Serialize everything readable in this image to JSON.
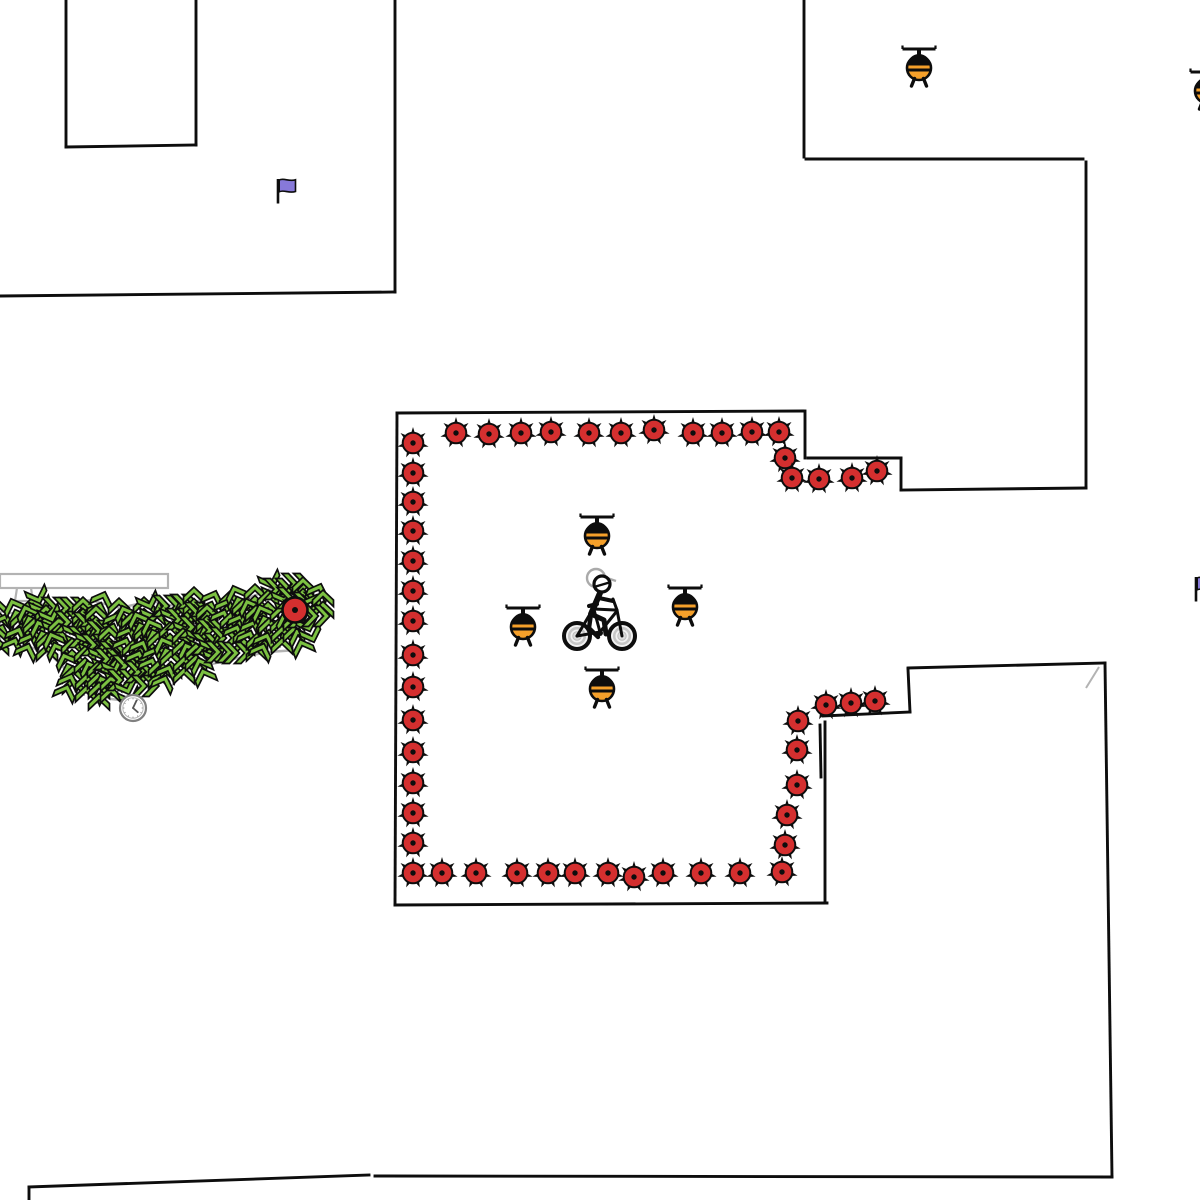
{
  "scene": {
    "width": 1200,
    "height": 1200,
    "background": "#ffffff"
  },
  "palette": {
    "wall_black": "#0d0d0d",
    "outline_gray": "#b3b3b3",
    "mine_red": "#d42f2f",
    "heli_orange": "#f5a02a",
    "tree_green": "#7cc142",
    "flag_purple": "#8779d9",
    "wheel_gray": "#c6c6c6",
    "hub_gray": "#dcdcdc",
    "clock_gray": "#808080",
    "ghost_gray": "#aaaaaa"
  },
  "walls": [
    [
      66,
      0,
      66,
      147
    ],
    [
      66,
      147,
      196,
      145
    ],
    [
      196,
      145,
      196,
      0
    ],
    [
      395,
      0,
      395,
      292
    ],
    [
      0,
      296,
      395,
      292
    ],
    [
      804,
      0,
      804,
      157
    ],
    [
      806,
      159,
      1083,
      159
    ],
    [
      1086,
      162,
      1086,
      488
    ],
    [
      1086,
      488,
      901,
      490
    ],
    [
      901,
      458,
      901,
      490
    ],
    [
      808,
      458,
      901,
      458
    ],
    [
      805,
      411,
      805,
      458
    ],
    [
      397,
      413,
      803,
      411
    ],
    [
      397,
      413,
      395,
      905
    ],
    [
      395,
      905,
      827,
      903
    ],
    [
      825,
      903,
      825,
      722
    ],
    [
      820,
      725,
      821,
      777
    ],
    [
      823,
      716,
      910,
      712
    ],
    [
      910,
      712,
      908,
      669
    ],
    [
      908,
      668,
      1105,
      663
    ],
    [
      1105,
      663,
      1112,
      1177
    ],
    [
      29,
      1187,
      369,
      1175
    ],
    [
      29,
      1187,
      29,
      1200
    ],
    [
      375,
      1176,
      1112,
      1177
    ]
  ],
  "corner_marks": [
    [
      1099,
      667,
      1086,
      688
    ]
  ],
  "mines": [
    [
      456,
      433
    ],
    [
      489,
      434
    ],
    [
      521,
      433
    ],
    [
      551,
      432
    ],
    [
      589,
      433
    ],
    [
      621,
      433
    ],
    [
      654,
      430
    ],
    [
      693,
      433
    ],
    [
      722,
      433
    ],
    [
      752,
      432
    ],
    [
      779,
      432
    ],
    [
      785,
      458
    ],
    [
      792,
      478
    ],
    [
      819,
      479
    ],
    [
      852,
      478
    ],
    [
      877,
      471
    ],
    [
      413,
      443
    ],
    [
      413,
      473
    ],
    [
      413,
      502
    ],
    [
      413,
      531
    ],
    [
      413,
      561
    ],
    [
      413,
      591
    ],
    [
      413,
      621
    ],
    [
      413,
      655
    ],
    [
      413,
      687
    ],
    [
      413,
      720
    ],
    [
      413,
      752
    ],
    [
      413,
      783
    ],
    [
      413,
      813
    ],
    [
      413,
      843
    ],
    [
      413,
      873
    ],
    [
      442,
      873
    ],
    [
      476,
      873
    ],
    [
      517,
      873
    ],
    [
      548,
      873
    ],
    [
      575,
      873
    ],
    [
      608,
      873
    ],
    [
      634,
      877
    ],
    [
      663,
      873
    ],
    [
      701,
      873
    ],
    [
      740,
      873
    ],
    [
      782,
      872
    ],
    [
      785,
      845
    ],
    [
      787,
      815
    ],
    [
      797,
      785
    ],
    [
      797,
      750
    ],
    [
      798,
      721
    ],
    [
      826,
      705
    ],
    [
      851,
      703
    ],
    [
      875,
      701
    ]
  ],
  "red_ball": [
    295,
    610
  ],
  "helicopters": [
    [
      597,
      536
    ],
    [
      523,
      627
    ],
    [
      685,
      607
    ],
    [
      602,
      689
    ],
    [
      919,
      68
    ],
    [
      1207,
      91
    ]
  ],
  "cyclist": {
    "x": 600,
    "y": 612
  },
  "flags": [
    [
      278,
      179
    ],
    [
      1196,
      577
    ]
  ],
  "clock": [
    133,
    708
  ],
  "stand": {
    "bar": [
      0,
      574,
      168,
      14
    ],
    "legs": [
      [
        17,
        588,
        15,
        601
      ],
      [
        31,
        588,
        33,
        601
      ]
    ],
    "base": [
      [
        11,
        601
      ],
      [
        36,
        601
      ],
      [
        40,
        613
      ],
      [
        7,
        613
      ]
    ]
  },
  "tree_area": {
    "outline": [
      [
        0,
        612
      ],
      [
        40,
        604
      ],
      [
        60,
        607
      ],
      [
        90,
        600
      ],
      [
        120,
        608
      ],
      [
        150,
        601
      ],
      [
        180,
        607
      ],
      [
        210,
        597
      ],
      [
        235,
        603
      ],
      [
        256,
        595
      ],
      [
        270,
        589
      ],
      [
        300,
        586
      ],
      [
        318,
        590
      ],
      [
        324,
        599
      ],
      [
        321,
        620
      ],
      [
        311,
        641
      ],
      [
        297,
        650
      ],
      [
        268,
        652
      ],
      [
        238,
        658
      ],
      [
        208,
        665
      ],
      [
        178,
        672
      ],
      [
        154,
        680
      ],
      [
        137,
        691
      ],
      [
        128,
        701
      ],
      [
        111,
        699
      ],
      [
        92,
        693
      ],
      [
        76,
        684
      ],
      [
        65,
        669
      ],
      [
        51,
        655
      ],
      [
        33,
        648
      ],
      [
        16,
        645
      ],
      [
        0,
        642
      ]
    ],
    "columns": [
      [
        2,
        614,
        645
      ],
      [
        16,
        610,
        648
      ],
      [
        30,
        606,
        650
      ],
      [
        44,
        604,
        648
      ],
      [
        58,
        606,
        652
      ],
      [
        72,
        610,
        690
      ],
      [
        86,
        608,
        696
      ],
      [
        100,
        606,
        698
      ],
      [
        114,
        610,
        700
      ],
      [
        128,
        614,
        698
      ],
      [
        142,
        610,
        688
      ],
      [
        156,
        607,
        682
      ],
      [
        170,
        608,
        676
      ],
      [
        184,
        604,
        672
      ],
      [
        198,
        602,
        668
      ],
      [
        212,
        602,
        664
      ],
      [
        226,
        600,
        660
      ],
      [
        240,
        598,
        657
      ],
      [
        254,
        594,
        654
      ],
      [
        268,
        590,
        652
      ],
      [
        282,
        588,
        650
      ],
      [
        296,
        587,
        646
      ],
      [
        308,
        589,
        638
      ],
      [
        318,
        592,
        628
      ]
    ],
    "step": 13
  }
}
